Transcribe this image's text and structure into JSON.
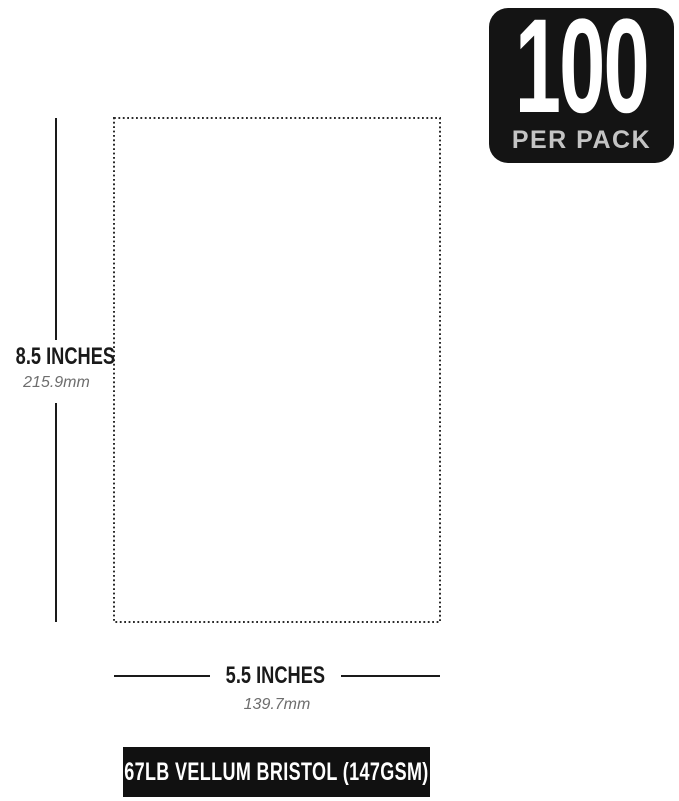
{
  "badge": {
    "count": "100",
    "subtitle": "PER PACK"
  },
  "dimensions": {
    "height": {
      "inches_label": "8.5 INCHES",
      "metric_label": "215.9mm"
    },
    "width": {
      "inches_label": "5.5 INCHES",
      "metric_label": "139.7mm"
    }
  },
  "footer": {
    "label": "67LB VELLUM BRISTOL (147GSM)"
  },
  "colors": {
    "background": "#ffffff",
    "badge_bg": "#141414",
    "badge_count_text": "#ffffff",
    "badge_subtitle_text": "#c4c4c4",
    "dimension_line": "#1a1a1a",
    "dimension_text": "#1a1a1a",
    "metric_text": "#6e6e6e",
    "footer_bg": "#111111",
    "footer_text": "#ffffff",
    "paper_outline": "#2a2a2a"
  }
}
